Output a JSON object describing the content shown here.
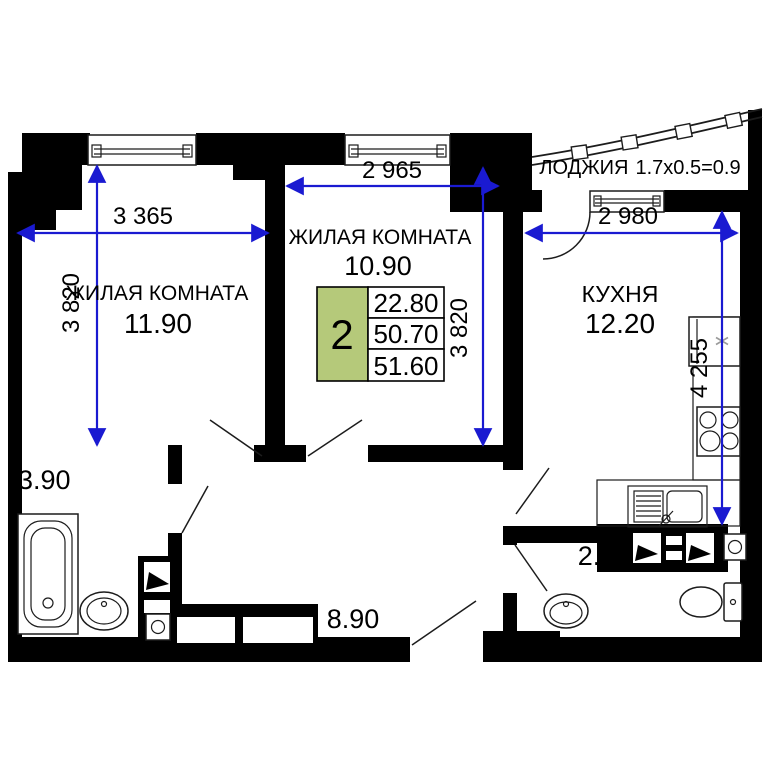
{
  "colors": {
    "wall": "#000000",
    "dim_line": "#1a1ad1",
    "accent_green": "#b5c97a",
    "text": "#000000"
  },
  "rooms": {
    "living1": {
      "name": "ЖИЛАЯ КОМНАТА",
      "area": "11.90"
    },
    "living2": {
      "name": "ЖИЛАЯ КОМНАТА",
      "area": "10.90"
    },
    "kitchen": {
      "name": "КУХНЯ",
      "area": "12.20"
    },
    "loggia": {
      "name": "ЛОДЖИЯ",
      "size": "1.7x0.5=0.9"
    },
    "bathroom": {
      "area": "3.90"
    },
    "hallway": {
      "area": "8.90"
    },
    "wc": {
      "area": "2.90"
    }
  },
  "summary": {
    "room_count": "2",
    "living_area": "22.80",
    "area_without_loggia": "50.70",
    "total_area": "51.60"
  },
  "dimensions": {
    "living1_width": "3 365",
    "living1_height": "3 820",
    "living2_width": "2 965",
    "living2_height": "3 820",
    "kitchen_width": "2 980",
    "kitchen_height": "4 255"
  }
}
